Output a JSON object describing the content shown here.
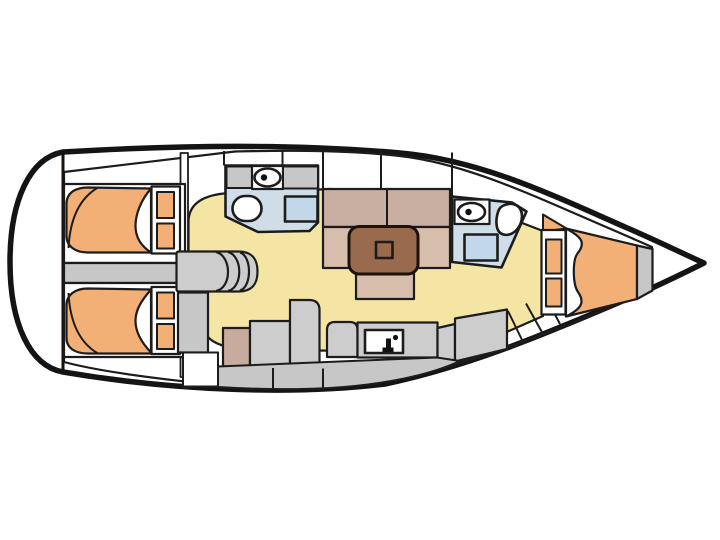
{
  "diagram": {
    "type": "boat-floor-plan",
    "subject": "Sailing yacht interior layout plan, top view, bow pointing right",
    "rooms": [
      "aft-cabin-port",
      "aft-cabin-starboard",
      "engine-compartment",
      "companionway-stairs",
      "aft-head",
      "saloon",
      "galley",
      "forward-head",
      "forward-cabin",
      "bow-locker"
    ],
    "fixtures": [
      "double-berth",
      "berth-steps",
      "toilet",
      "washbasin",
      "shower-tray",
      "dining-table",
      "settee",
      "galley-counter",
      "sink-with-faucet"
    ]
  },
  "palette": {
    "background": "#ffffff",
    "white": "#ffffff",
    "hull_line": "#141414",
    "line": "#1c1c1c",
    "deck": "#c7c7c7",
    "unit_gray": "#cdcdcd",
    "floor": "#f5e5a5",
    "berth_orange": "#f2b077",
    "head_blue": "#cfdde8",
    "shower_blue": "#c2d8ea",
    "settee_back": "#c9afa2",
    "settee_seat": "#d7bdac",
    "table_brown": "#9a6a4d",
    "galley_tan": "#c6ab9e",
    "black": "#111111"
  }
}
